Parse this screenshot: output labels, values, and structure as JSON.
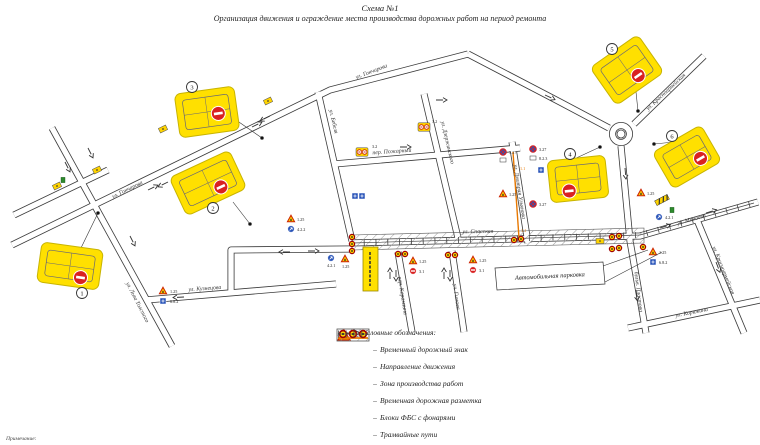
{
  "title": {
    "line1": "Схема №1",
    "line2": "Организация движения и ограждение места производства дорожных работ на период ремонта"
  },
  "footnote": "Примечание:",
  "legend": {
    "header": "Условные обозначения:",
    "dash": "–",
    "items": [
      {
        "icon": "temporary-road-sign-icon",
        "code": "1.25",
        "label": "Временный дорожный знак"
      },
      {
        "icon": "direction-arrow-icon",
        "code": "",
        "label": "Направление движения"
      },
      {
        "icon": "work-zone-hatch-icon",
        "code": "",
        "label": "Зона производства работ"
      },
      {
        "icon": "temporary-marking-icon",
        "code": "1.1",
        "label": "Временная дорожная разметка"
      },
      {
        "icon": "fbs-blocks-icon",
        "code": "",
        "label": "Блоки ФБС с фонарями"
      },
      {
        "icon": "tram-tracks-icon",
        "code": "",
        "label": "Трамвайные пути"
      }
    ]
  },
  "map": {
    "parking_label": "Автомобильная парковка",
    "markers": [
      "1",
      "2",
      "3",
      "4",
      "5",
      "6"
    ],
    "streets": [
      {
        "name": "ул. Гончарова"
      },
      {
        "name": "ул. Гончарова"
      },
      {
        "name": "ул. Льва Толстого"
      },
      {
        "name": "ул. Кузнецова"
      },
      {
        "name": "ул. Бебеля"
      },
      {
        "name": "пер. Пожарный"
      },
      {
        "name": "ул. Дзержинского"
      },
      {
        "name": "ул. Дмитрия Ульянова"
      },
      {
        "name": "ул. Спасская"
      },
      {
        "name": "пер. Карамзина"
      },
      {
        "name": "ул. Гимова"
      },
      {
        "name": "бульв. Пластова"
      },
      {
        "name": "ул. Красноармейская"
      },
      {
        "name": "ул. Красноармейская"
      },
      {
        "name": "ул. Минаева"
      },
      {
        "name": "ул. Корюкина"
      }
    ],
    "sign_codes": [
      {
        "code": "1.25"
      },
      {
        "code": "6.8.2"
      },
      {
        "code": "4.2.1"
      },
      {
        "code": "1.25"
      },
      {
        "code": "1.25"
      },
      {
        "code": "3.1"
      },
      {
        "code": "1.25"
      },
      {
        "code": "3.1"
      },
      {
        "code": "3.27"
      },
      {
        "code": "1.25"
      },
      {
        "code": "3.27"
      },
      {
        "code": "8.2.3"
      },
      {
        "code": "3.27"
      },
      {
        "code": "1.1"
      },
      {
        "code": "1.1"
      },
      {
        "code": "1.25"
      },
      {
        "code": "4.2.1"
      },
      {
        "code": "1.25"
      },
      {
        "code": "6.8.2"
      },
      {
        "code": "3.2"
      },
      {
        "code": "3.2"
      },
      {
        "code": "1.25"
      },
      {
        "code": "4.2.2"
      }
    ]
  }
}
